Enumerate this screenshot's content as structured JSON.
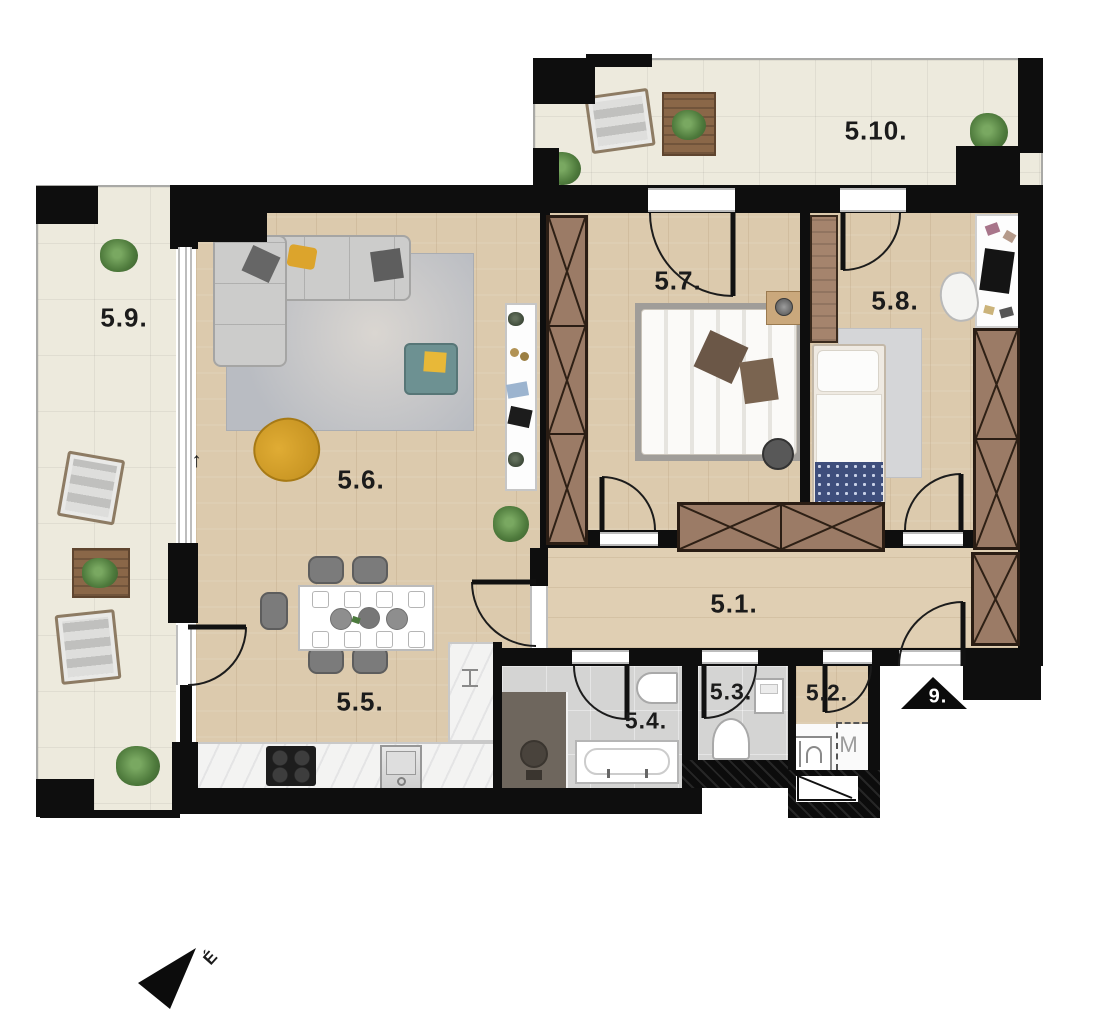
{
  "title": "apartment-floor-plan",
  "rooms": [
    {
      "id": "5.1",
      "label": "5.1."
    },
    {
      "id": "5.2",
      "label": "5.2."
    },
    {
      "id": "5.3",
      "label": "5.3."
    },
    {
      "id": "5.4",
      "label": "5.4."
    },
    {
      "id": "5.5",
      "label": "5.5."
    },
    {
      "id": "5.6",
      "label": "5.6."
    },
    {
      "id": "5.7",
      "label": "5.7."
    },
    {
      "id": "5.8",
      "label": "5.8."
    },
    {
      "id": "5.9",
      "label": "5.9."
    },
    {
      "id": "5.10",
      "label": "5.10."
    }
  ],
  "markers": {
    "entrance": "9.",
    "washing_machine": "M",
    "north": "É",
    "level_arrow": "↑"
  },
  "colors": {
    "wall": "#0e0e0e",
    "wood_floor": "#dccaad",
    "terrace_tile": "#edeadd",
    "bath_tile": "#d4d4d3",
    "wardrobe_brown": "#9b7b66",
    "sofa_gray": "#cccccb",
    "accent_yellow": "#dca42c",
    "ottoman_teal": "#6d9192",
    "blanket_blue": "#3e4e7c",
    "plant_green": "#4e7a3c",
    "shower_dark": "#6e665d",
    "counter_marble": "#f3f3f2"
  },
  "icons": {
    "north-arrow-icon": "black cone pointing south-west",
    "entrance-marker-icon": "black triangle with white 9.",
    "door-swing": "quarter-circle arc",
    "wardrobe-x": "crossed diagonals in cabinet",
    "stairs-shaft-icon": "white box with diagonal line"
  }
}
